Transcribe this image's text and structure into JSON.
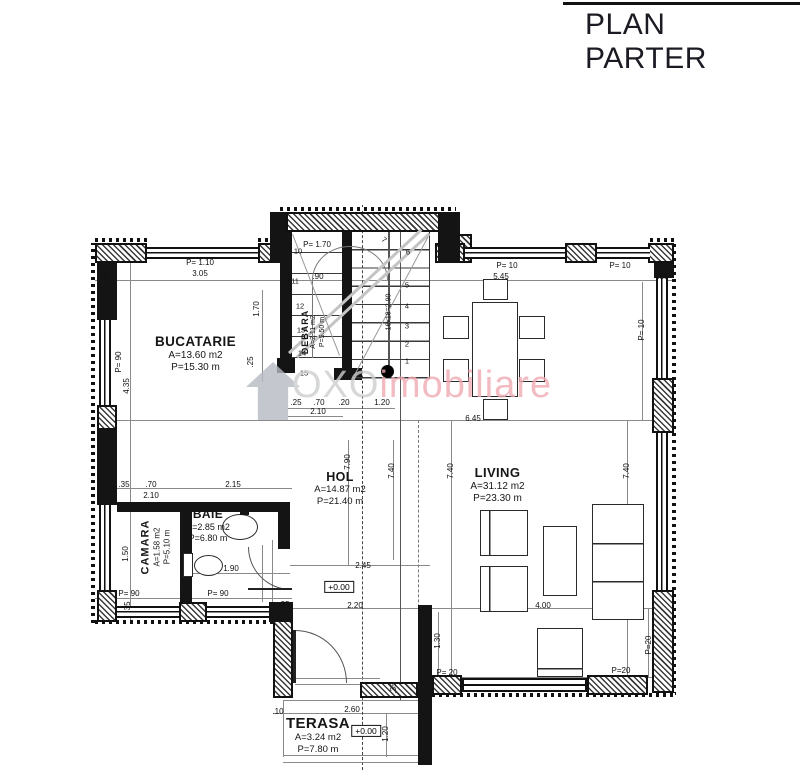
{
  "title": "PLAN PARTER",
  "watermark": {
    "oxo": "OXO",
    "imobiliare": "imobiliare",
    "gray": "#cdced0",
    "pink": "#f0aab2"
  },
  "rooms": {
    "bucatarie": {
      "name": "BUCATARIE",
      "area": "A=13.60 m2",
      "perimeter": "P=15.30 m"
    },
    "debara": {
      "name": "DEBARA",
      "area": "A=2.11 m2",
      "perimeter": "P=5.50 m"
    },
    "camara": {
      "name": "CAMARA",
      "area": "A=1.58 m2",
      "perimeter": "P=5.10 m"
    },
    "baie": {
      "name": "BAIE",
      "area": "A=2.85 m2",
      "perimeter": "P=6.80 m"
    },
    "hol": {
      "name": "HOL",
      "area": "A=14.87 m2",
      "perimeter": "P=21.40 m"
    },
    "living": {
      "name": "LIVING",
      "area": "A=31.12 m2",
      "perimeter": "P=23.30 m"
    },
    "terasa": {
      "name": "TERASA",
      "area": "A=3.24 m2",
      "perimeter": "P=7.80 m"
    }
  },
  "levels": {
    "hol": "+0.00",
    "terasa": "+0.00"
  },
  "stairs": {
    "note": "16x18=2.90",
    "up": [
      "1",
      "2",
      "3",
      "4",
      "5",
      "6",
      "7"
    ],
    "down": [
      "10",
      "11",
      "12",
      "13",
      "14",
      "15"
    ]
  },
  "dims": [
    "P= 1.10",
    "3.05",
    ".35",
    "P= 10",
    "5.45",
    "P= 10",
    ".35",
    "P= 1.70",
    ".90",
    "P= 90",
    "4.35",
    "1.50",
    ".35",
    ".70",
    "2.10",
    "2.15",
    "P= 90",
    "P= 90",
    ".35",
    "1.70",
    ".25",
    ".25",
    ".70",
    ".20",
    "1.20",
    "2.10",
    "6.45",
    "7.90",
    "7.40",
    "7.40",
    "7.40",
    "P= 10",
    "2.45",
    "2.20",
    "4.00",
    "1.30",
    "P= 20",
    "P=20",
    "P=20",
    ".35",
    ".35",
    ".10",
    "2.60",
    "1.20"
  ]
}
